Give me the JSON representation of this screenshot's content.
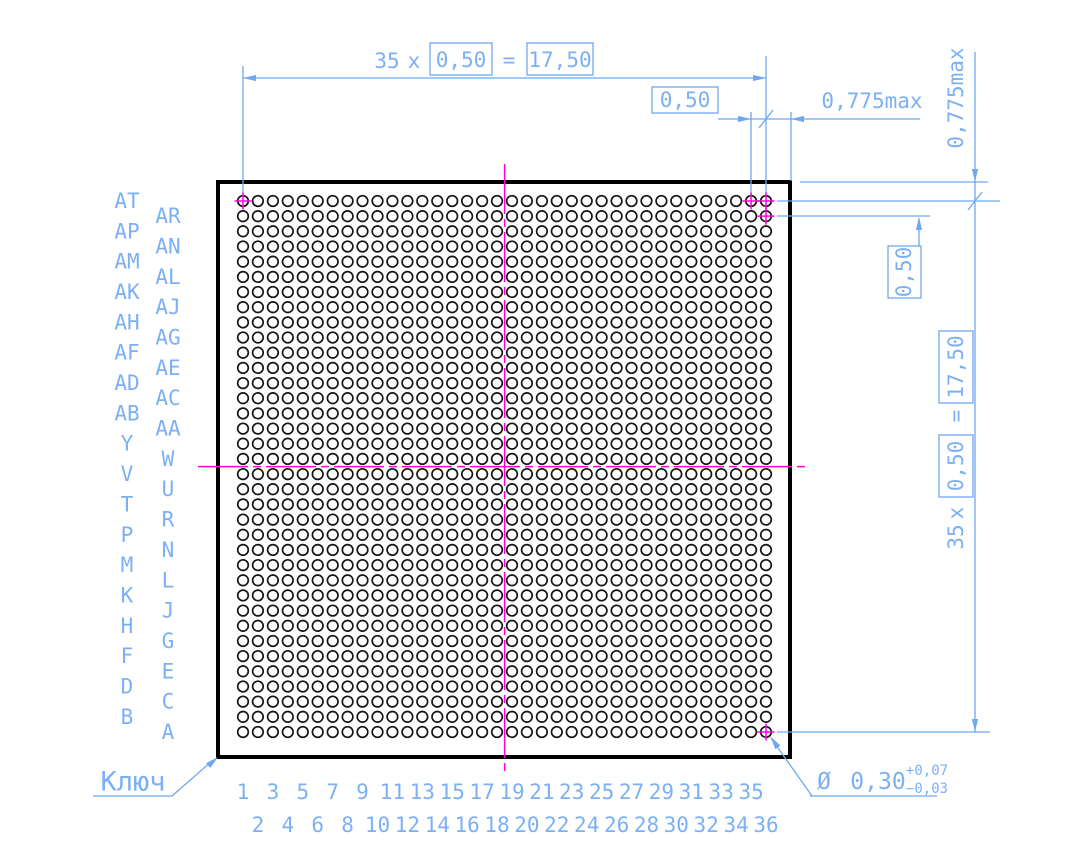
{
  "drawing": {
    "key_label": "Ключ",
    "colors": {
      "dimension_blue": "#6fa7f2",
      "text_blue": "#7cb0f5",
      "centerline_magenta": "#ff00dd",
      "outline_black": "#000000"
    },
    "dimensions": {
      "h_pitch": {
        "count": "35",
        "mult": "x",
        "pitch": "0,50",
        "equals": "=",
        "total": "17,50"
      },
      "h_gap": "0,50",
      "h_edge": "0,775max",
      "v_edge": "0,775max",
      "v_gap": "0,50",
      "v_pitch": {
        "count": "35",
        "mult": "x",
        "pitch": "0,50",
        "equals": "=",
        "total": "17,50"
      },
      "ball_diameter": {
        "symbol": "Ø",
        "value": "0,30",
        "tol_plus": "+0,07",
        "tol_minus": "−0,03"
      }
    },
    "grid": {
      "rows": 36,
      "cols": 36,
      "row_labels_outer": [
        "AT",
        "AP",
        "AM",
        "AK",
        "AH",
        "AF",
        "AD",
        "AB",
        "Y",
        "V",
        "T",
        "P",
        "M",
        "K",
        "H",
        "F",
        "D",
        "B"
      ],
      "row_labels_inner": [
        "AR",
        "AN",
        "AL",
        "AJ",
        "AG",
        "AE",
        "AC",
        "AA",
        "W",
        "U",
        "R",
        "N",
        "L",
        "J",
        "G",
        "E",
        "C",
        "A"
      ],
      "col_labels_odd": [
        "1",
        "3",
        "5",
        "7",
        "9",
        "11",
        "13",
        "15",
        "17",
        "19",
        "21",
        "23",
        "25",
        "27",
        "29",
        "31",
        "33",
        "35"
      ],
      "col_labels_even": [
        "2",
        "4",
        "6",
        "8",
        "10",
        "12",
        "14",
        "16",
        "18",
        "20",
        "22",
        "24",
        "26",
        "28",
        "30",
        "32",
        "34",
        "36"
      ],
      "marked_pads": [
        {
          "row": 1,
          "col": 1
        },
        {
          "row": 1,
          "col": 35
        },
        {
          "row": 1,
          "col": 36
        },
        {
          "row": 2,
          "col": 36
        },
        {
          "row": 36,
          "col": 36
        }
      ]
    }
  }
}
